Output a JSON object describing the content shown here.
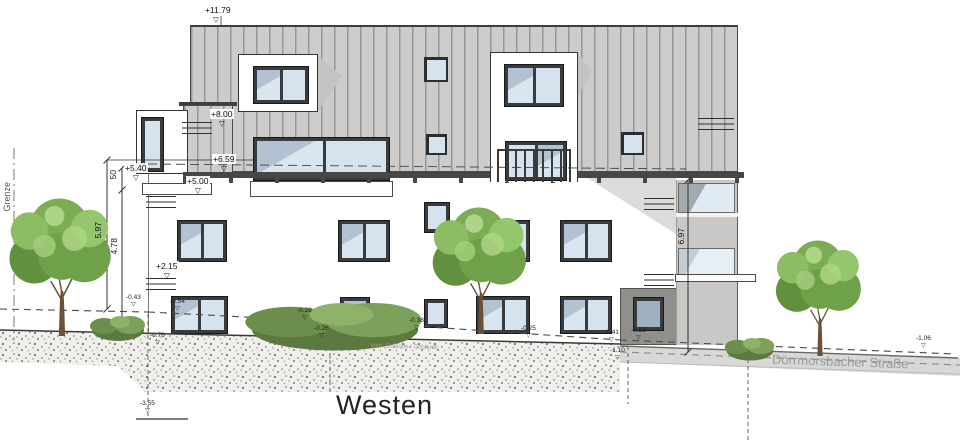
{
  "drawing": {
    "title": "Westen",
    "street": "Dörrmorsbacher Straße",
    "boundary": "Grenze",
    "ground_line_label": "Vorh. Gelände / Gebäude"
  },
  "levels": {
    "ridge": "+11.79",
    "tower_upper": "+8.00",
    "tower_lower": "+6.59",
    "attic_parapet": "+5.40",
    "attic_floor": "+5.00",
    "upper_floor": "+2.15"
  },
  "dims": {
    "parapet_height": "50",
    "height_left_outer": "5.97",
    "height_left_inner": "4.78",
    "height_right": "6.97"
  },
  "ground_markers": [
    {
      "label": "-0.43"
    },
    {
      "label": "-0.54"
    },
    {
      "label": "-0.76"
    },
    {
      "label": "-0.28"
    },
    {
      "label": "-0.26"
    },
    {
      "label": "-0.38"
    },
    {
      "label": "-0.25"
    },
    {
      "label": "-0.41"
    },
    {
      "label": "-0.52"
    },
    {
      "label": "-1.10"
    },
    {
      "label": "-1.06"
    },
    {
      "label": "-3.55"
    }
  ],
  "colors": {
    "roof": "#cdccca",
    "roof_stripe": "#969694",
    "window_frame": "#383c3f",
    "glass": "#d9e5ef",
    "side_wall": "#c9c8c6",
    "street": "#d8d8d6",
    "tree_green": "#6fa04a"
  }
}
